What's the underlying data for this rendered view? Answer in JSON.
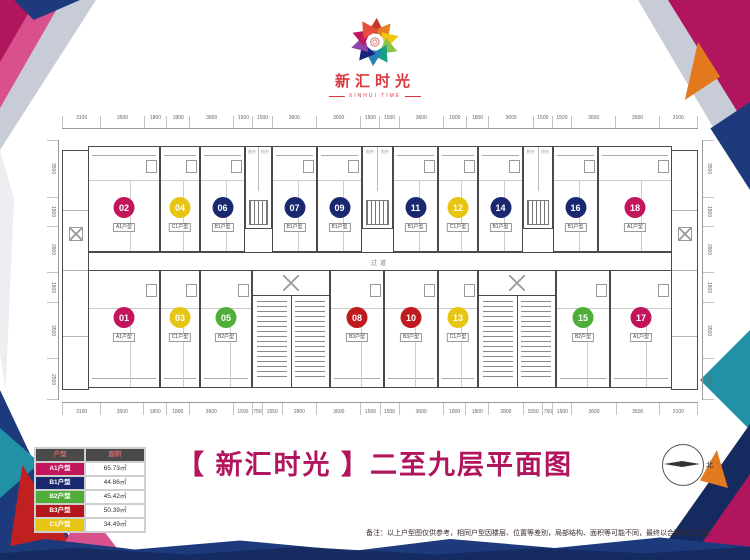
{
  "logo": {
    "name_cn": "新汇时光",
    "name_en": "XINHUI TIME"
  },
  "title": "【 新汇时光 】二至九层平面图",
  "note": "备注：以上户型图仅供参考，相同户型因楼层、位置等差别，局部结构、面积等可能不同，最终以合同约定为准。",
  "compass_label": "北",
  "palette": {
    "brand_magenta": "#b0155e",
    "logo_red": "#d9383e",
    "navy": "#1c3a7c",
    "teal": "#2191a6",
    "orange": "#e2791f",
    "red": "#c02020",
    "silver": "#c8ccd6"
  },
  "legend": {
    "headers": [
      "户型",
      "面积"
    ],
    "rows": [
      {
        "type": "A1户型",
        "area": "65.73㎡",
        "color": "#c2155c"
      },
      {
        "type": "B1户型",
        "area": "44.86㎡",
        "color": "#1a2870"
      },
      {
        "type": "B2户型",
        "area": "45.42㎡",
        "color": "#4fae38"
      },
      {
        "type": "B3户型",
        "area": "50.39㎡",
        "color": "#b5161c"
      },
      {
        "type": "C1户型",
        "area": "34.49㎡",
        "color": "#e7c512"
      }
    ]
  },
  "plan": {
    "corridor_label": "过道",
    "balcony_label": "阳台",
    "dims": {
      "top": [
        "3100",
        "3500",
        "1800",
        "1800",
        "3600",
        "1500",
        "1500",
        "3600",
        "3600",
        "1500",
        "1500",
        "3600",
        "1800",
        "1800",
        "3600",
        "1500",
        "1500",
        "3600",
        "3500",
        "3100"
      ],
      "bottom": [
        "3100",
        "3500",
        "1800",
        "1800",
        "3600",
        "1500",
        "750",
        "1550",
        "2800",
        "3600",
        "1500",
        "1500",
        "3600",
        "1800",
        "1800",
        "2800",
        "1550",
        "750",
        "1500",
        "3600",
        "3500",
        "3100"
      ],
      "left": [
        "3500",
        "1800",
        "2800",
        "1800",
        "3500",
        "2500"
      ],
      "right": [
        "3500",
        "1800",
        "2800",
        "1800",
        "3500",
        "2500"
      ]
    },
    "top_units": [
      {
        "no": "02",
        "type": "A1户型",
        "color": "#c2155c",
        "x": 26,
        "w": 72
      },
      {
        "no": "04",
        "type": "C1户型",
        "color": "#e7c512",
        "x": 98,
        "w": 40
      },
      {
        "no": "06",
        "type": "B1户型",
        "color": "#1a2870",
        "x": 138,
        "w": 45
      },
      {
        "no": "07",
        "type": "B1户型",
        "color": "#1a2870",
        "x": 210,
        "w": 45
      },
      {
        "no": "09",
        "type": "B1户型",
        "color": "#1a2870",
        "x": 255,
        "w": 45
      },
      {
        "no": "11",
        "type": "B1户型",
        "color": "#1a2870",
        "x": 331,
        "w": 45
      },
      {
        "no": "12",
        "type": "C1户型",
        "color": "#e7c512",
        "x": 376,
        "w": 40
      },
      {
        "no": "14",
        "type": "B1户型",
        "color": "#1a2870",
        "x": 416,
        "w": 45
      },
      {
        "no": "16",
        "type": "B1户型",
        "color": "#1a2870",
        "x": 491,
        "w": 45
      },
      {
        "no": "18",
        "type": "A1户型",
        "color": "#c2155c",
        "x": 536,
        "w": 74
      }
    ],
    "bottom_units": [
      {
        "no": "01",
        "type": "A1户型",
        "color": "#c2155c",
        "x": 26,
        "w": 72
      },
      {
        "no": "03",
        "type": "C1户型",
        "color": "#e7c512",
        "x": 98,
        "w": 40
      },
      {
        "no": "05",
        "type": "B2户型",
        "color": "#4fae38",
        "x": 138,
        "w": 52
      },
      {
        "no": "08",
        "type": "B3户型",
        "color": "#c0191e",
        "x": 268,
        "w": 54
      },
      {
        "no": "10",
        "type": "B3户型",
        "color": "#c0191e",
        "x": 322,
        "w": 54
      },
      {
        "no": "13",
        "type": "C1户型",
        "color": "#e7c512",
        "x": 376,
        "w": 40
      },
      {
        "no": "15",
        "type": "B2户型",
        "color": "#4fae38",
        "x": 494,
        "w": 54
      },
      {
        "no": "17",
        "type": "A1户型",
        "color": "#c2155c",
        "x": 548,
        "w": 62
      }
    ],
    "blocks": [
      {
        "kind": "shaft",
        "row": "top",
        "x": 183,
        "w": 27
      },
      {
        "kind": "shaft",
        "row": "top",
        "x": 300,
        "w": 31
      },
      {
        "kind": "shaft",
        "row": "top",
        "x": 461,
        "w": 30
      },
      {
        "kind": "stair",
        "row": "bottom",
        "x": 190,
        "w": 78
      },
      {
        "kind": "stair",
        "row": "bottom",
        "x": 416,
        "w": 78
      }
    ]
  }
}
